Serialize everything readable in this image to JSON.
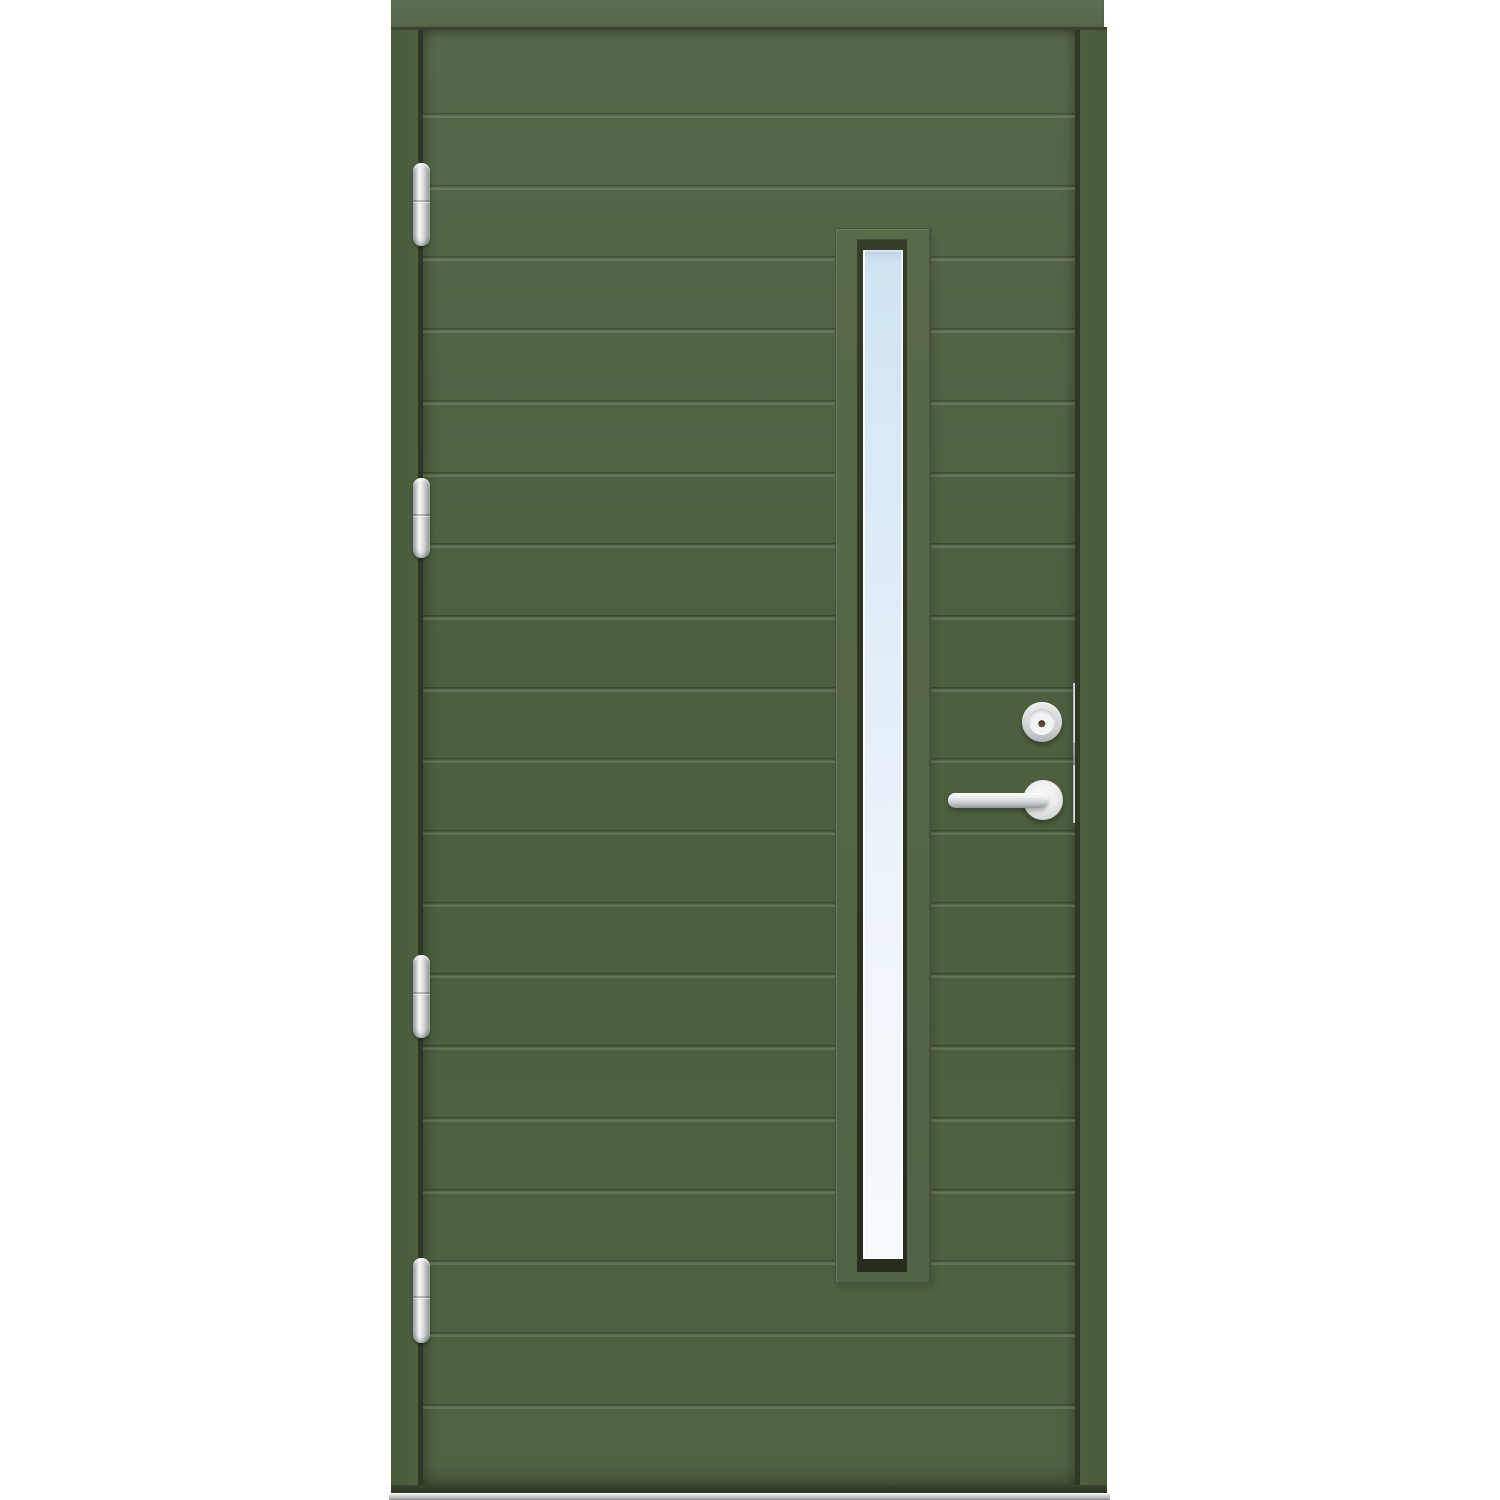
{
  "scene": {
    "description": "Green exterior entry door with horizontal plank grooves, four stainless barrel hinges, full-height vertical glazing strip, stainless cylinder lock and lever handle, edge strike plate and aluminium threshold on a white background",
    "background_color": "#ffffff"
  },
  "colors": {
    "background": "#ffffff",
    "head_band_top": "#5e6e50",
    "head_band_bottom": "#57684a",
    "seam_dark": "#39432f",
    "jamb_green": "#4f6040",
    "jamb_green_dark": "#49593b",
    "gap_dark": "#2e3827",
    "leaf_green_top": "#57684a",
    "leaf_green_mid": "#4d5f3f",
    "leaf_green_bottom": "#516243",
    "trim_green_top": "#586948",
    "trim_green_bottom": "#526345",
    "trim_outline": "#45523a",
    "sash_dark_top": "#333d2a",
    "sash_dark_bottom": "#252d1f",
    "glass_top": "#cfe3f2",
    "glass_mid": "#e0ecf7",
    "glass_bottom": "#f7fafd",
    "metal_light": "#f8f8f8",
    "metal_mid": "#d6d8d9",
    "metal_dark": "#94989a",
    "cylinder_face": "#f3f3f1",
    "keyhole": "#5c4737",
    "sill_light": "#f2f2f2",
    "sill_dark": "#9e9e9e",
    "threshold_dark": "#2b3321"
  },
  "geometry": {
    "unit": {
      "x": 391,
      "y": 0,
      "width": 716,
      "height": 1500
    },
    "head": {
      "x": 0,
      "y": 0,
      "width": 713,
      "height": 27
    },
    "head_seam": {
      "x": 0,
      "y": 27,
      "width": 716,
      "height": 3
    },
    "jamb_left": {
      "x": 0,
      "y": 30,
      "width": 27,
      "height": 1463
    },
    "gap_left": {
      "x": 27,
      "y": 30,
      "width": 5,
      "height": 1463
    },
    "leaf": {
      "x": 32,
      "y": 30,
      "width": 653,
      "height": 1455
    },
    "gap_right": {
      "x": 684,
      "y": 30,
      "width": 5,
      "height": 1463
    },
    "jamb_right": {
      "x": 689,
      "y": 30,
      "width": 27,
      "height": 1463
    },
    "threshold_shadow": {
      "x": 0,
      "y": 1485,
      "width": 716,
      "height": 8
    },
    "sill": {
      "x": -2,
      "y": 1493,
      "width": 721,
      "height": 7
    },
    "window_trim": {
      "x": 413,
      "y": 199,
      "width": 94,
      "height": 1054
    },
    "window_sash": {
      "x": 434,
      "y": 209,
      "width": 50,
      "height": 1033
    },
    "window_glass": {
      "x": 440,
      "y": 220,
      "width": 40,
      "height": 1009
    },
    "cylinder": {
      "x": 599,
      "y": 672,
      "width": 40,
      "height": 40
    },
    "rose": {
      "x": 600,
      "y": 750,
      "width": 40,
      "height": 40
    },
    "lever": {
      "x": 525,
      "y": 763,
      "width": 100,
      "height": 15
    },
    "strike_plate": {
      "x": 650,
      "y": 653,
      "width": 5,
      "height": 140
    },
    "latch": {
      "y": 60,
      "height": 22
    }
  },
  "grooves": {
    "count": 19,
    "start_y": 83,
    "spacing": 71.7,
    "thickness": 5
  },
  "hinges": {
    "x": 22,
    "width": 17,
    "items": [
      {
        "y": 163,
        "height": 83
      },
      {
        "y": 478,
        "height": 80
      },
      {
        "y": 955,
        "height": 83
      },
      {
        "y": 1258,
        "height": 85
      }
    ]
  }
}
